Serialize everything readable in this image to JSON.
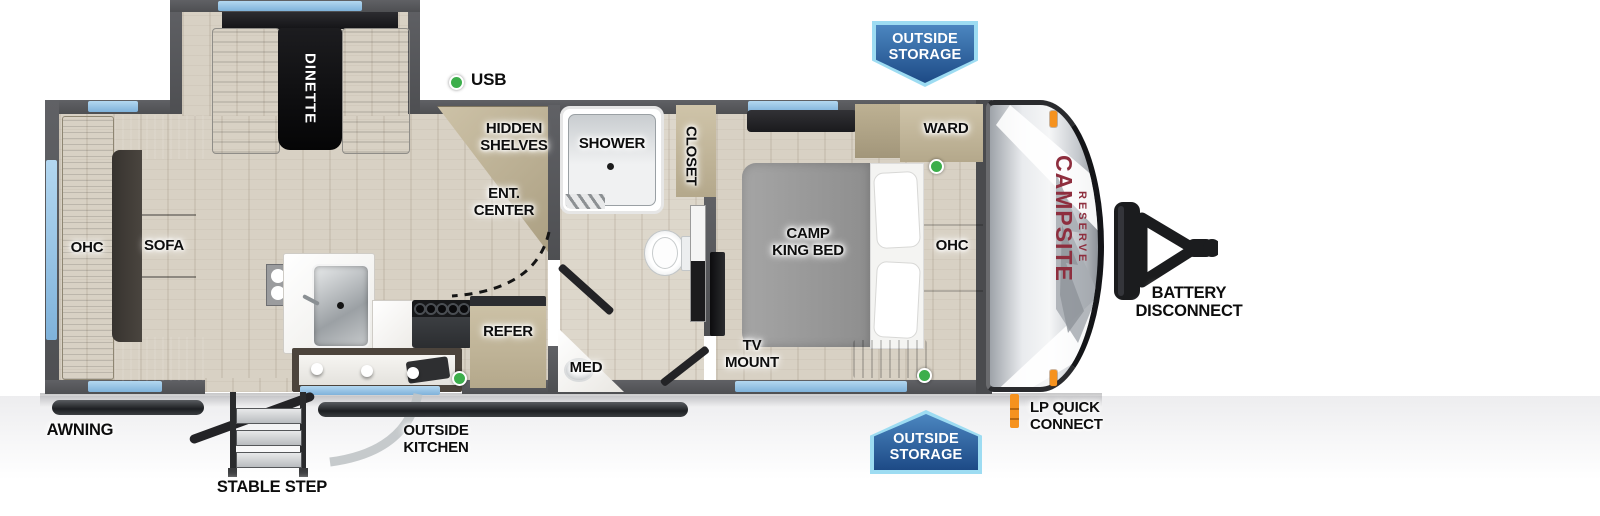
{
  "brand": {
    "name": "CAMPSITE",
    "series": "RESERVE"
  },
  "labels": {
    "usb": "USB",
    "dinette": "DINETTE",
    "hidden_shelves": "HIDDEN\nSHELVES",
    "ent_center": "ENT.\nCENTER",
    "shower": "SHOWER",
    "closet": "CLOSET",
    "med": "MED",
    "refer": "REFER",
    "sofa": "SOFA",
    "ohc_rear": "OHC",
    "camp_king_bed": "CAMP\nKING BED",
    "ward": "WARD",
    "ohc_front": "OHC",
    "tv_mount": "TV\nMOUNT",
    "awning": "AWNING",
    "stable_step": "STABLE STEP",
    "outside_kitchen": "OUTSIDE\nKITCHEN",
    "battery_disconnect": "BATTERY\nDISCONNECT",
    "lp_quick_connect": "LP QUICK\nCONNECT"
  },
  "badges": {
    "outside_storage_top": "OUTSIDE\nSTORAGE",
    "outside_storage_bottom": "OUTSIDE\nSTORAGE"
  },
  "colors": {
    "wall": "#56575a",
    "window": "#8fc1e4",
    "badge_fill": "#2a62a8",
    "badge_border": "#9ddcf2",
    "brand_text": "#8e2e3e",
    "usb_indicator": "#3cae4b",
    "lp_indicator": "#f6921e"
  }
}
